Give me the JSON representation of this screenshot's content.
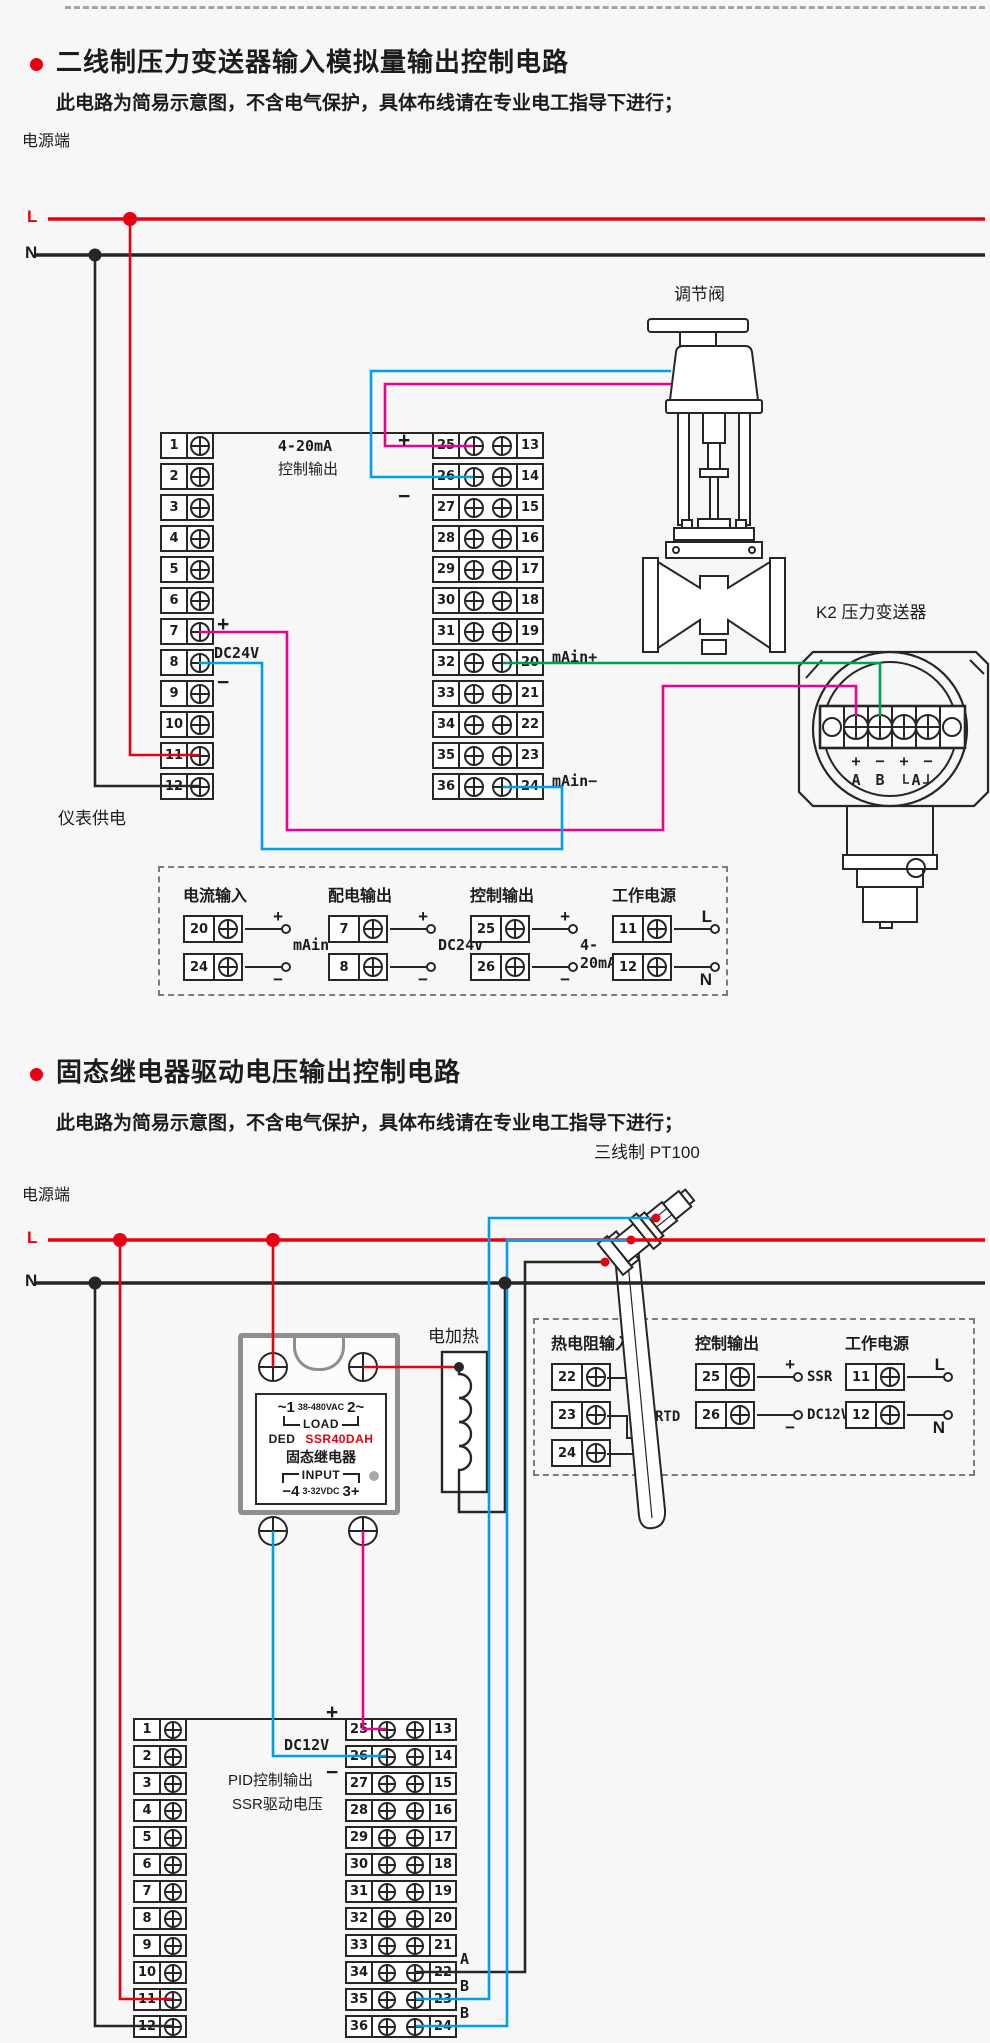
{
  "colors": {
    "bg": "#f7f7f7",
    "red": "#e60012",
    "magenta": "#ec008c",
    "cyan": "#00a0e9",
    "green": "#009e4f",
    "line": "#262626"
  },
  "section1": {
    "title": "二线制压力变送器输入模拟量输出控制电路",
    "subtitle": "此电路为简易示意图，不含电气保护，具体布线请在专业电工指导下进行；",
    "power_label": "电源端",
    "l": "L",
    "n": "N",
    "block_left_numbers": [
      "1",
      "2",
      "3",
      "4",
      "5",
      "6",
      "7",
      "8",
      "9",
      "10",
      "11",
      "12"
    ],
    "block_mid_left": [
      "25",
      "26",
      "27",
      "28",
      "29",
      "30",
      "31",
      "32",
      "33",
      "34",
      "35",
      "36"
    ],
    "block_mid_right": [
      "13",
      "14",
      "15",
      "16",
      "17",
      "18",
      "19",
      "20",
      "21",
      "22",
      "23",
      "24"
    ],
    "labels": {
      "out_current": "4-20mA",
      "out_ctrl": "控制输出",
      "plus": "+",
      "minus": "−",
      "dc24v": "DC24V",
      "main_plus": "mAin+",
      "main_minus": "mAin−",
      "meter_supply": "仪表供电",
      "valve": "调节阀",
      "transmitter": "K2  压力变送器"
    },
    "transmitter_marks": [
      "+",
      "−",
      "+",
      "−"
    ],
    "transmitter_letters": [
      "A",
      "B",
      "A"
    ],
    "legend": {
      "groups": [
        {
          "title": "电流输入",
          "rows": [
            {
              "num": "20",
              "mark": "+"
            },
            {
              "num": "24",
              "mark": "−"
            }
          ],
          "label": "mAin"
        },
        {
          "title": "配电输出",
          "rows": [
            {
              "num": "7",
              "mark": "+"
            },
            {
              "num": "8",
              "mark": "−"
            }
          ],
          "label": "DC24V"
        },
        {
          "title": "控制输出",
          "rows": [
            {
              "num": "25",
              "mark": "+"
            },
            {
              "num": "26",
              "mark": "−"
            }
          ],
          "label": "4-20mA"
        },
        {
          "title": "工作电源",
          "rows": [
            {
              "num": "11",
              "mark": "L"
            },
            {
              "num": "12",
              "mark": "N"
            }
          ],
          "label": ""
        }
      ]
    }
  },
  "section2": {
    "title": "固态继电器驱动电压输出控制电路",
    "subtitle": "此电路为简易示意图，不含电气保护，具体布线请在专业电工指导下进行；",
    "power_label": "电源端",
    "l": "L",
    "n": "N",
    "heater": "电加热",
    "pt100": "三线制  PT100",
    "block_left_numbers": [
      "1",
      "2",
      "3",
      "4",
      "5",
      "6",
      "7",
      "8",
      "9",
      "10",
      "11",
      "12"
    ],
    "block_mid_left": [
      "25",
      "26",
      "27",
      "28",
      "29",
      "30",
      "31",
      "32",
      "33",
      "34",
      "35",
      "36"
    ],
    "block_mid_right": [
      "13",
      "14",
      "15",
      "16",
      "17",
      "18",
      "19",
      "20",
      "21",
      "22",
      "23",
      "24"
    ],
    "ssr": {
      "t1": "~1",
      "vac": "38-480VAC",
      "t2": "2~",
      "load": "LOAD",
      "brand": "DED",
      "model": "SSR40DAH",
      "name": "固态继电器",
      "input": "INPUT",
      "t4": "−4",
      "vdc": "3-32VDC",
      "t3": "3+"
    },
    "labels": {
      "plus": "+",
      "minus": "−",
      "dc12v": "DC12V",
      "pid1": "PID控制输出",
      "pid2": "SSR驱动电压",
      "a": "A",
      "b1": "B",
      "b2": "B"
    },
    "legend": {
      "groups": [
        {
          "title": "热电阻输入",
          "rows": [
            {
              "num": "22"
            },
            {
              "num": "23"
            },
            {
              "num": "24"
            }
          ],
          "label": "RTD",
          "rtd": true
        },
        {
          "title": "控制输出",
          "rows": [
            {
              "num": "25",
              "mark": "+",
              "label": "SSR"
            },
            {
              "num": "26",
              "mark": "−",
              "label": "DC12V"
            }
          ],
          "label": ""
        },
        {
          "title": "工作电源",
          "rows": [
            {
              "num": "11",
              "mark": "L"
            },
            {
              "num": "12",
              "mark": "N"
            }
          ],
          "label": ""
        }
      ]
    }
  }
}
